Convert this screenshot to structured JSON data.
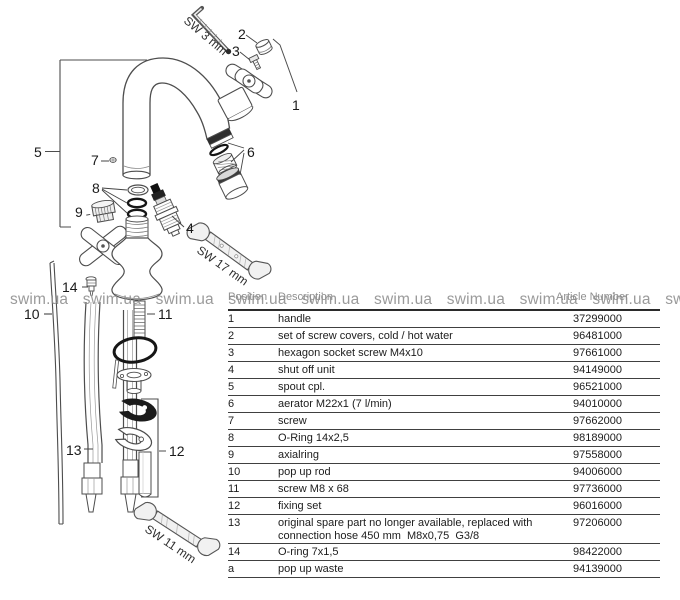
{
  "watermark": {
    "text": "swim.ua",
    "count": 10,
    "color": "#8d8d8d"
  },
  "diagram": {
    "part_labels": {
      "p1": "1",
      "p2": "2",
      "p3": "3",
      "p4": "4",
      "p5": "5",
      "p6": "6",
      "p7": "7",
      "p8": "8",
      "p9": "9",
      "p10": "10",
      "p11": "11",
      "p12": "12",
      "p13": "13",
      "p14": "14"
    },
    "tool_labels": {
      "sw3": "SW 3 mm",
      "sw17": "SW 17 mm",
      "sw11": "SW 11 mm"
    }
  },
  "table": {
    "headers": {
      "position": "Position",
      "description": "Description",
      "article": "Article Number"
    },
    "rows": [
      {
        "pos": "1",
        "desc": "handle",
        "article": "37299000"
      },
      {
        "pos": "2",
        "desc": "set of screw covers, cold / hot water",
        "article": "96481000"
      },
      {
        "pos": "3",
        "desc": "hexagon socket screw M4x10",
        "article": "97661000"
      },
      {
        "pos": "4",
        "desc": "shut off unit",
        "article": "94149000"
      },
      {
        "pos": "5",
        "desc": "spout cpl.",
        "article": "96521000"
      },
      {
        "pos": "6",
        "desc": "aerator M22x1 (7 l/min)",
        "article": "94010000"
      },
      {
        "pos": "7",
        "desc": "screw",
        "article": "97662000"
      },
      {
        "pos": "8",
        "desc": "O-Ring 14x2,5",
        "article": "98189000"
      },
      {
        "pos": "9",
        "desc": "axialring",
        "article": "97558000"
      },
      {
        "pos": "10",
        "desc": "pop up rod",
        "article": "94006000"
      },
      {
        "pos": "11",
        "desc": "screw M8 x 68",
        "article": "97736000"
      },
      {
        "pos": "12",
        "desc": "fixing set",
        "article": "96016000"
      },
      {
        "pos": "13",
        "desc": "original spare part no longer available, replaced with\nconnection hose 450 mm  M8x0,75  G3/8",
        "article": "97206000"
      },
      {
        "pos": "14",
        "desc": "O-ring 7x1,5",
        "article": "98422000"
      },
      {
        "pos": "a",
        "desc": "pop up waste",
        "article": "94139000"
      }
    ]
  }
}
